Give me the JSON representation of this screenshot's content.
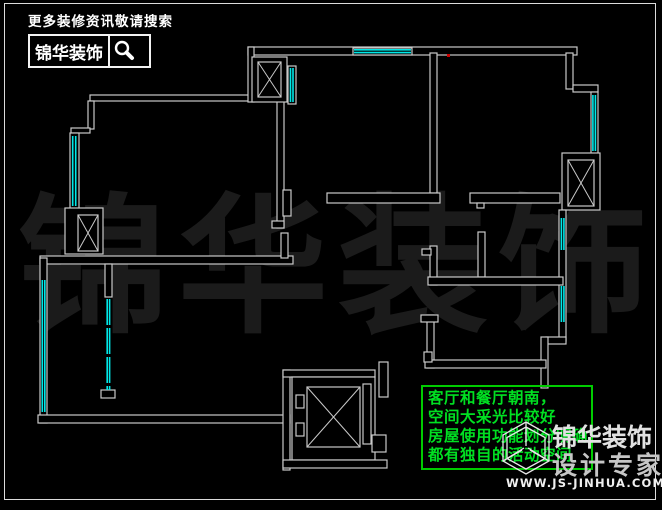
{
  "colors": {
    "background": "#000000",
    "wall_line": "#c9c9c9",
    "window_accent": "#00e8e8",
    "note_green": "#00cc00",
    "note_text_green": "#00e022",
    "watermark_gray": "#1b1b1b",
    "marker_red": "#cc0000"
  },
  "header": {
    "tagline": "更多装修资讯敬请搜索",
    "brand_name": "锦华装饰",
    "search_icon": "magnifier"
  },
  "watermark": {
    "characters": {
      "c0": "锦",
      "c1": "华",
      "c2": "装",
      "c3": "饰"
    }
  },
  "note_box": {
    "lines": {
      "l0": "客厅和餐厅朝南，",
      "l1": "空间大采光比较好",
      "l2": "房屋使用功能划分明确",
      "l3": "都有独自的活动空间"
    }
  },
  "footer_logo": {
    "cube_icon": "wireframe-cube",
    "brand_name": "锦华装饰",
    "subtitle": "设计专家",
    "website": "WWW.JS-JINHUA.COM"
  }
}
